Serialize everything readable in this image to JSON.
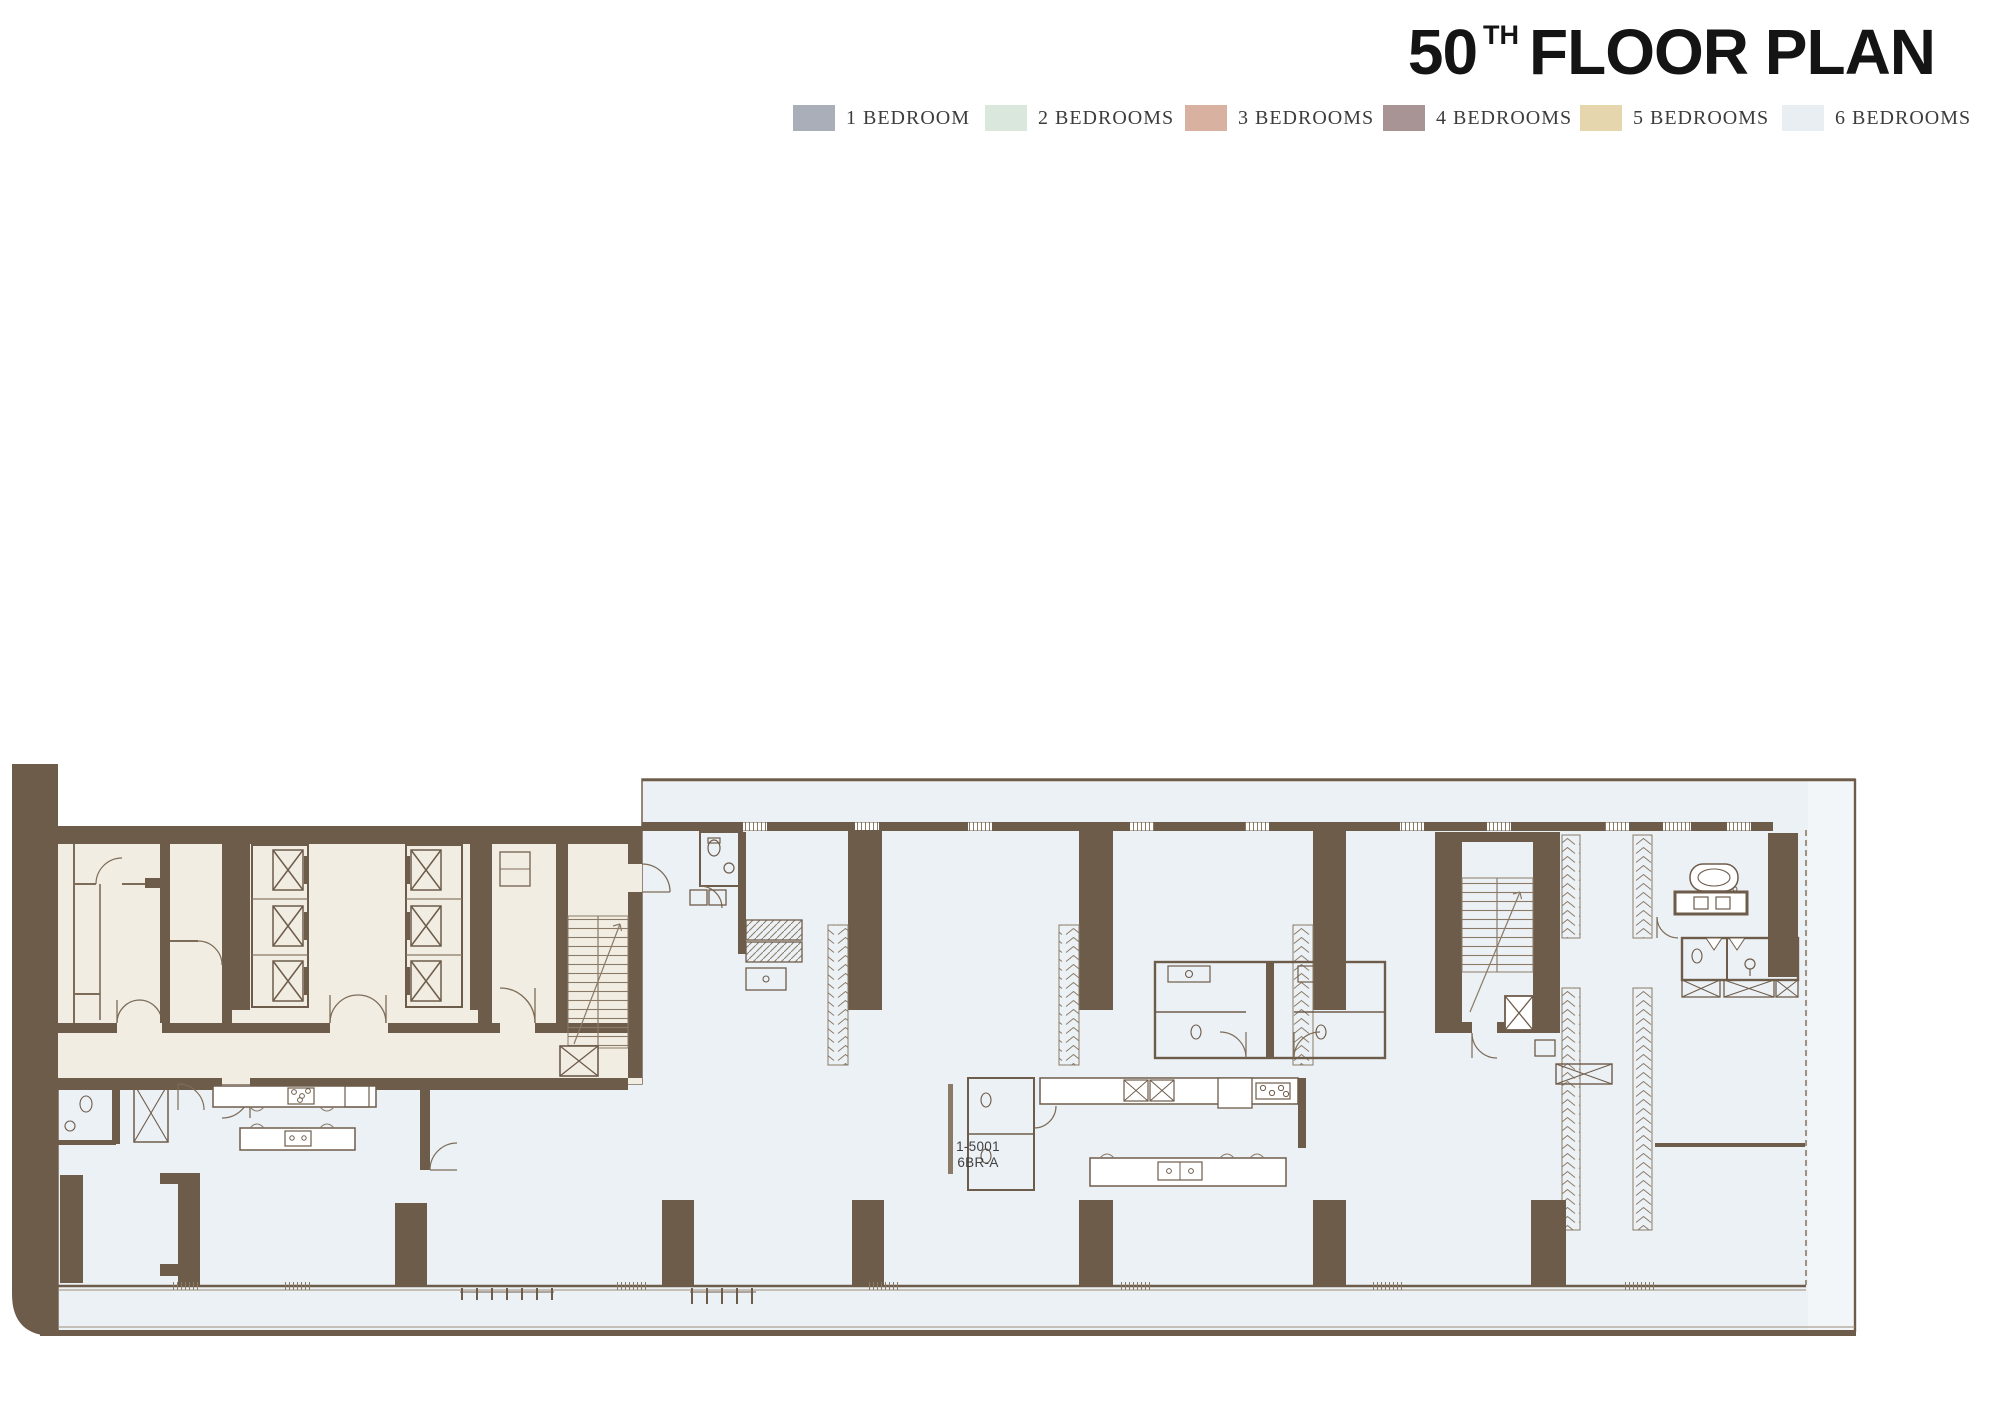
{
  "title": {
    "floor_number": "50",
    "ordinal_suffix": "TH",
    "title_rest": "FLOOR PLAN"
  },
  "legend": {
    "items": [
      {
        "label": "1 BEDROOM",
        "color": "#a9aeb8"
      },
      {
        "label": "2 BEDROOMS",
        "color": "#d9e7dd"
      },
      {
        "label": "3 BEDROOMS",
        "color": "#d9b1a0"
      },
      {
        "label": "4 BEDROOMS",
        "color": "#a89495"
      },
      {
        "label": "5 BEDROOMS",
        "color": "#e5d6ae"
      },
      {
        "label": "6 BEDROOMS",
        "color": "#e9eef3"
      }
    ]
  },
  "floor_plan": {
    "unit": {
      "number": "1-5001",
      "type": "6BR-A"
    },
    "colors": {
      "walls": "#6e5c4b",
      "thin_lines": "#7d6c58",
      "core_fill": "#f1ede3",
      "unit_6br_fill": "#ecf1f5",
      "side_strip_fill": "#f3f6f9",
      "background": "#ffffff"
    }
  }
}
